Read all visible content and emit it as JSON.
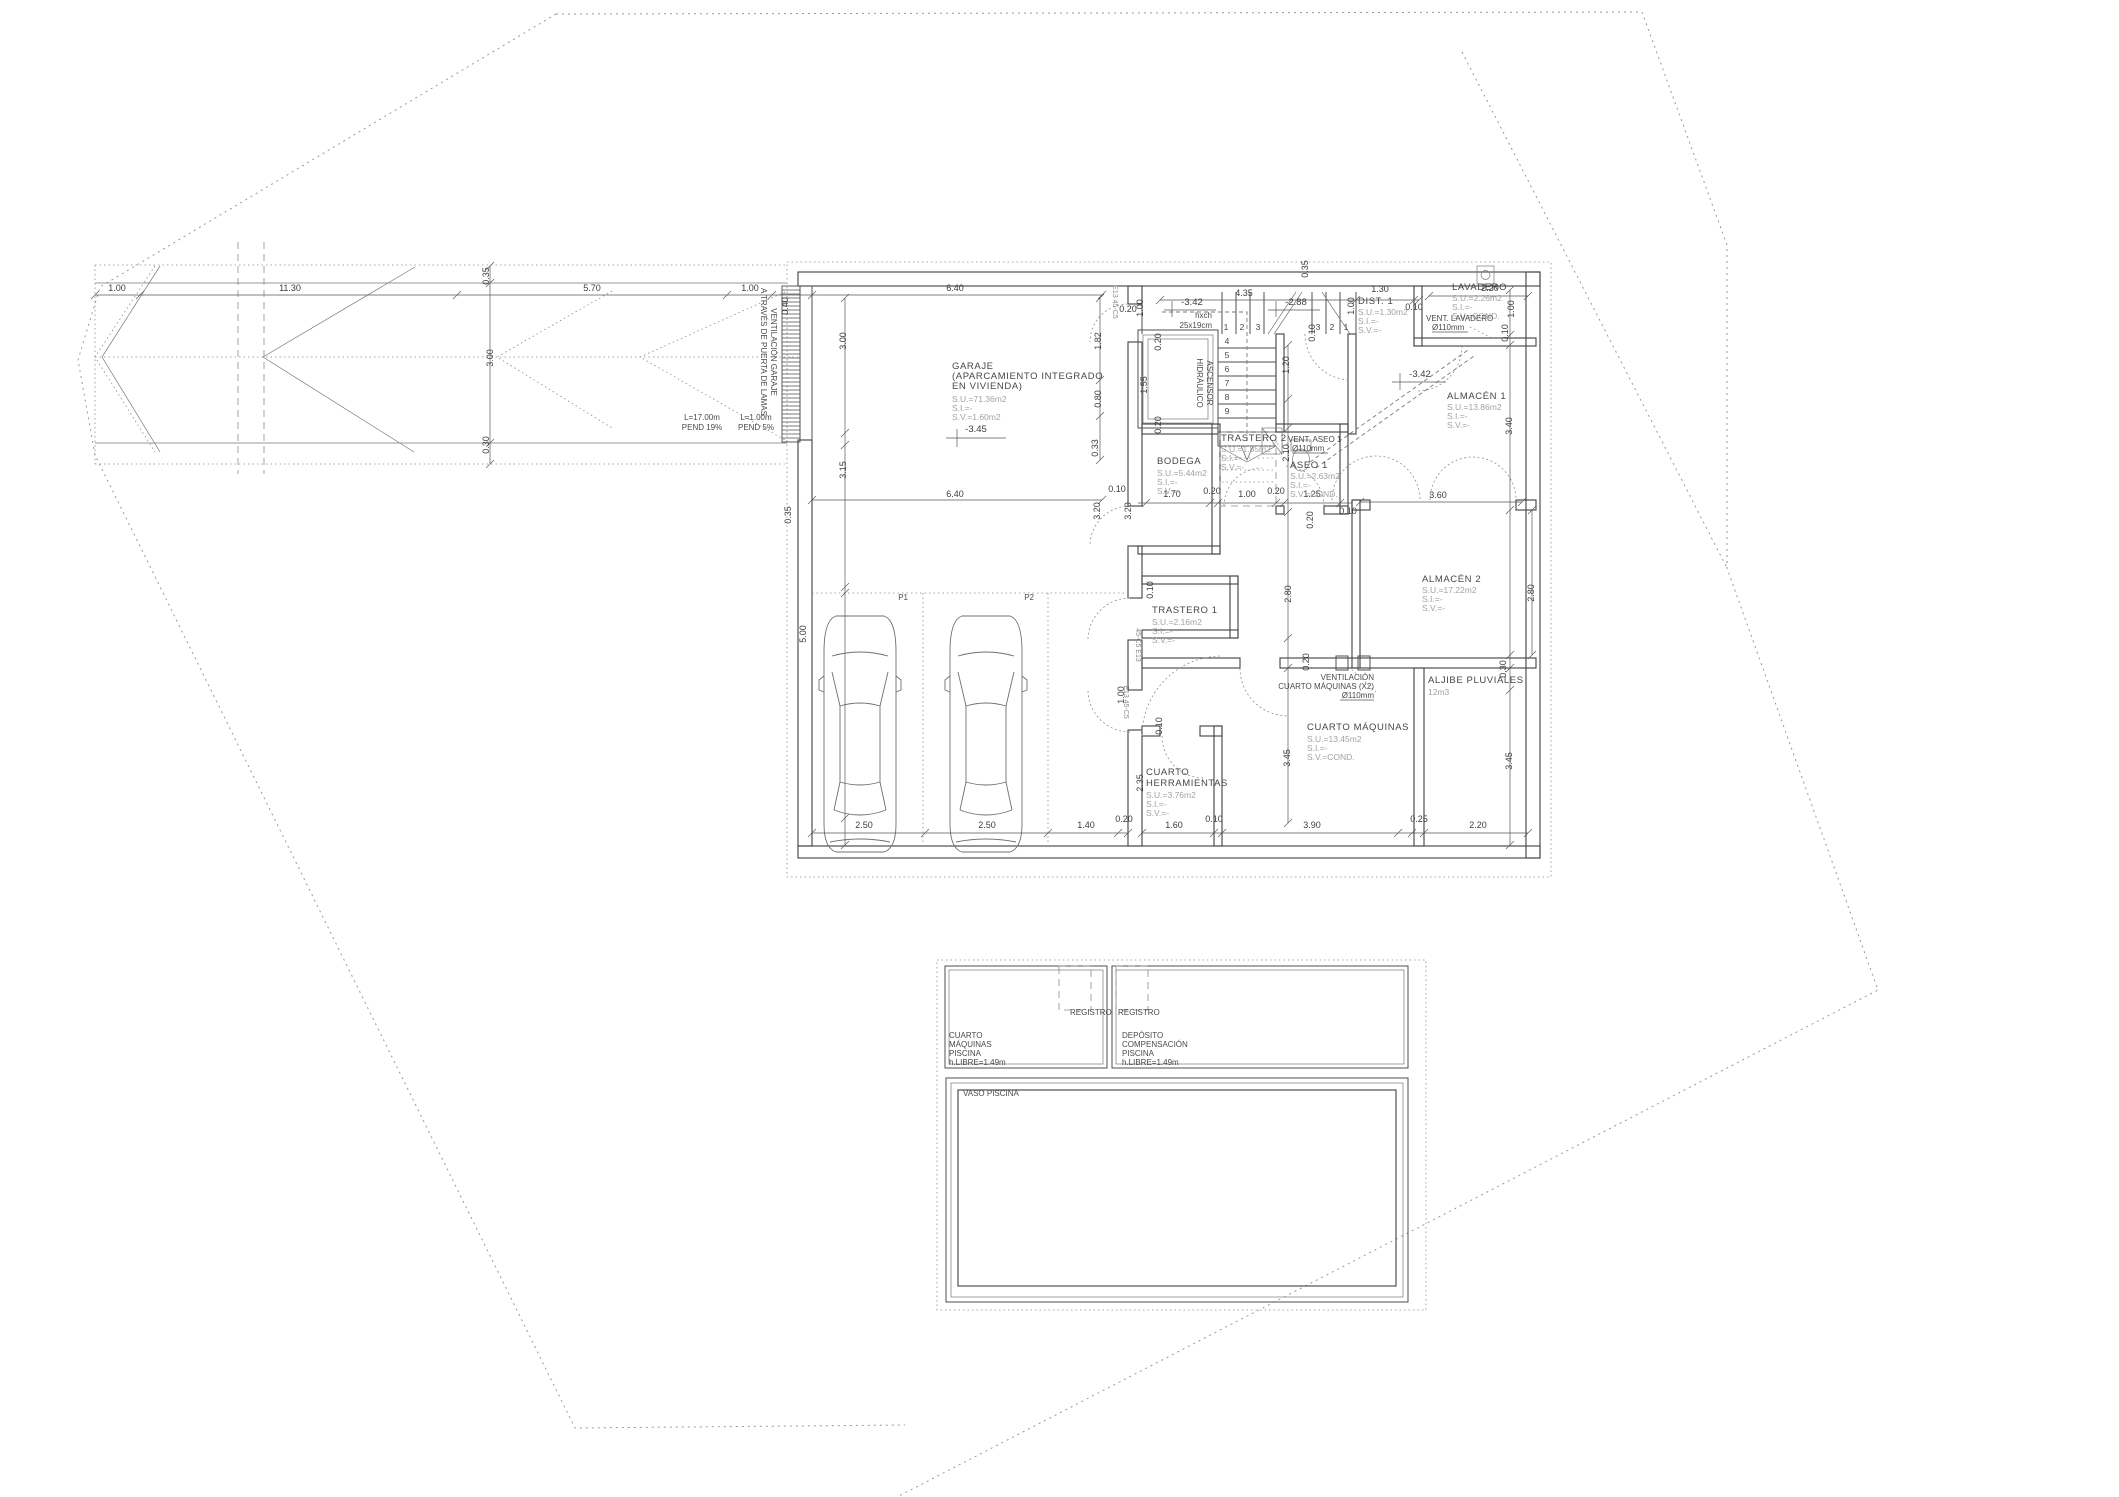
{
  "drawing": {
    "kind": "basement floor plan",
    "line_color": "#4f4f4f",
    "muted_text_color": "#a2a2a2",
    "background": "#ffffff"
  },
  "texts": [
    {
      "t": "1.00",
      "x": 117,
      "y": 291,
      "c": "dim"
    },
    {
      "t": "11.30",
      "x": 290,
      "y": 291,
      "c": "dim"
    },
    {
      "t": "5.70",
      "x": 592,
      "y": 291,
      "c": "dim"
    },
    {
      "t": "1.00",
      "x": 750,
      "y": 291,
      "c": "dim"
    },
    {
      "t": "6.40",
      "x": 955,
      "y": 291,
      "c": "dim"
    },
    {
      "t": "4.35",
      "x": 1244,
      "y": 296,
      "c": "dim"
    },
    {
      "t": "1.30",
      "x": 1380,
      "y": 292,
      "c": "dim"
    },
    {
      "t": "0.10",
      "x": 1414,
      "y": 310,
      "c": "dim"
    },
    {
      "t": "2.20",
      "x": 1490,
      "y": 291,
      "c": "dim"
    },
    {
      "t": "6.40",
      "x": 955,
      "y": 497,
      "c": "dim"
    },
    {
      "t": "0.10",
      "x": 1117,
      "y": 492,
      "c": "dim"
    },
    {
      "t": "1.70",
      "x": 1172,
      "y": 497,
      "c": "dim"
    },
    {
      "t": "0.20",
      "x": 1212,
      "y": 494,
      "c": "dim"
    },
    {
      "t": "1.00",
      "x": 1247,
      "y": 497,
      "c": "dim"
    },
    {
      "t": "0.20",
      "x": 1276,
      "y": 494,
      "c": "dim"
    },
    {
      "t": "1.25",
      "x": 1312,
      "y": 497,
      "c": "dim"
    },
    {
      "t": "0.10",
      "x": 1348,
      "y": 514,
      "c": "dim"
    },
    {
      "t": "3.60",
      "x": 1438,
      "y": 498,
      "c": "dim"
    },
    {
      "t": "0.20",
      "x": 1128,
      "y": 312,
      "c": "dim"
    },
    {
      "t": "2.50",
      "x": 864,
      "y": 828,
      "c": "dim"
    },
    {
      "t": "2.50",
      "x": 987,
      "y": 828,
      "c": "dim"
    },
    {
      "t": "1.40",
      "x": 1086,
      "y": 828,
      "c": "dim"
    },
    {
      "t": "0.20",
      "x": 1124,
      "y": 822,
      "c": "dim"
    },
    {
      "t": "1.60",
      "x": 1174,
      "y": 828,
      "c": "dim"
    },
    {
      "t": "0.10",
      "x": 1214,
      "y": 822,
      "c": "dim"
    },
    {
      "t": "3.90",
      "x": 1312,
      "y": 828,
      "c": "dim"
    },
    {
      "t": "0.25",
      "x": 1419,
      "y": 822,
      "c": "dim"
    },
    {
      "t": "2.20",
      "x": 1478,
      "y": 828,
      "c": "dim"
    },
    {
      "t": "0.35",
      "x": 489,
      "y": 276,
      "r": -90,
      "c": "dim"
    },
    {
      "t": "3.00",
      "x": 493,
      "y": 358,
      "r": -90,
      "c": "dim"
    },
    {
      "t": "0.30",
      "x": 489,
      "y": 445,
      "r": -90,
      "c": "dim"
    },
    {
      "t": "0.40",
      "x": 788,
      "y": 306,
      "r": -90,
      "c": "dim"
    },
    {
      "t": "3.00",
      "x": 846,
      "y": 341,
      "r": -90,
      "c": "dim"
    },
    {
      "t": "3.15",
      "x": 846,
      "y": 470,
      "r": -90,
      "c": "dim"
    },
    {
      "t": "0.35",
      "x": 791,
      "y": 515,
      "r": -90,
      "c": "dim"
    },
    {
      "t": "5.00",
      "x": 806,
      "y": 634,
      "r": -90,
      "c": "dim"
    },
    {
      "t": "1.82",
      "x": 1101,
      "y": 341,
      "r": -90,
      "c": "dim"
    },
    {
      "t": "0.80",
      "x": 1101,
      "y": 399,
      "r": -90,
      "c": "dim"
    },
    {
      "t": "0.33",
      "x": 1098,
      "y": 448,
      "r": -90,
      "c": "dim"
    },
    {
      "t": "1.55",
      "x": 1147,
      "y": 385,
      "r": -90,
      "c": "dim"
    },
    {
      "t": "0.20",
      "x": 1161,
      "y": 342,
      "r": -90,
      "c": "dim"
    },
    {
      "t": "0.20",
      "x": 1161,
      "y": 425,
      "r": -90,
      "c": "dim"
    },
    {
      "t": "1.00",
      "x": 1143,
      "y": 308,
      "r": -90,
      "c": "dim"
    },
    {
      "t": "0.35",
      "x": 1308,
      "y": 269,
      "r": -90,
      "c": "dim"
    },
    {
      "t": "1.00",
      "x": 1354,
      "y": 306,
      "r": -90,
      "c": "dim"
    },
    {
      "t": "1.20",
      "x": 1289,
      "y": 365,
      "r": -90,
      "c": "dim"
    },
    {
      "t": "0.10",
      "x": 1315,
      "y": 333,
      "r": -90,
      "c": "dim"
    },
    {
      "t": "2.10",
      "x": 1289,
      "y": 453,
      "r": -90,
      "c": "dim"
    },
    {
      "t": "0.20",
      "x": 1313,
      "y": 520,
      "r": -90,
      "c": "dim"
    },
    {
      "t": "3.20",
      "x": 1100,
      "y": 511,
      "r": -90,
      "c": "dim"
    },
    {
      "t": "3.20",
      "x": 1131,
      "y": 511,
      "r": -90,
      "c": "dim"
    },
    {
      "t": "1.00",
      "x": 1514,
      "y": 309,
      "r": -90,
      "c": "dim"
    },
    {
      "t": "0.10",
      "x": 1508,
      "y": 333,
      "r": -90,
      "c": "dim"
    },
    {
      "t": "3.40",
      "x": 1512,
      "y": 426,
      "r": -90,
      "c": "dim"
    },
    {
      "t": "2.80",
      "x": 1291,
      "y": 594,
      "r": -90,
      "c": "dim"
    },
    {
      "t": "2.80",
      "x": 1534,
      "y": 593,
      "r": -90,
      "c": "dim"
    },
    {
      "t": "0.20",
      "x": 1309,
      "y": 662,
      "r": -90,
      "c": "dim"
    },
    {
      "t": "0.30",
      "x": 1506,
      "y": 669,
      "r": -90,
      "c": "dim"
    },
    {
      "t": "3.45",
      "x": 1290,
      "y": 758,
      "r": -90,
      "c": "dim"
    },
    {
      "t": "3.45",
      "x": 1512,
      "y": 761,
      "r": -90,
      "c": "dim"
    },
    {
      "t": "2.35",
      "x": 1143,
      "y": 783,
      "r": -90,
      "c": "dim"
    },
    {
      "t": "1.00",
      "x": 1124,
      "y": 695,
      "r": -90,
      "c": "dim"
    },
    {
      "t": "0.10",
      "x": 1162,
      "y": 726,
      "r": -90,
      "c": "dim"
    },
    {
      "t": "0.10",
      "x": 1153,
      "y": 590,
      "r": -90,
      "c": "dim"
    },
    {
      "t": "-3.45",
      "x": 976,
      "y": 432,
      "c": "level",
      "n": "level-garaje"
    },
    {
      "t": "-3.42",
      "x": 1192,
      "y": 305,
      "c": "level",
      "n": "level-stair-landing"
    },
    {
      "t": "-2.88",
      "x": 1296,
      "y": 305,
      "c": "level",
      "n": "level-stair-mid"
    },
    {
      "t": "-3.42",
      "x": 1420,
      "y": 377,
      "c": "level",
      "n": "level-dist"
    },
    {
      "t": "GARAJE",
      "x": 952,
      "y": 369,
      "c": "room",
      "n": "room-label-garaje"
    },
    {
      "t": "(APARCAMIENTO INTEGRADO",
      "x": 952,
      "y": 379,
      "c": "room"
    },
    {
      "t": "EN VIVIENDA)",
      "x": 952,
      "y": 389,
      "c": "room"
    },
    {
      "t": "S.U.=71.36m2",
      "x": 952,
      "y": 402,
      "c": "sub"
    },
    {
      "t": "S.I.=-",
      "x": 952,
      "y": 411,
      "c": "sub"
    },
    {
      "t": "S.V.=1.60m2",
      "x": 952,
      "y": 420,
      "c": "sub"
    },
    {
      "t": "BODEGA",
      "x": 1157,
      "y": 464,
      "c": "room",
      "n": "room-label-bodega"
    },
    {
      "t": "S.U.=5.44m2",
      "x": 1157,
      "y": 476,
      "c": "sub"
    },
    {
      "t": "S.I.=-",
      "x": 1157,
      "y": 485,
      "c": "sub"
    },
    {
      "t": "S.V.=-",
      "x": 1157,
      "y": 494,
      "c": "sub"
    },
    {
      "t": "TRASTERO 2",
      "x": 1221,
      "y": 441,
      "c": "room",
      "n": "room-label-trastero-2"
    },
    {
      "t": "S.U.=1.85m2",
      "x": 1221,
      "y": 452,
      "c": "sub"
    },
    {
      "t": "S.I.=-",
      "x": 1221,
      "y": 461,
      "c": "sub"
    },
    {
      "t": "S.V.=-",
      "x": 1221,
      "y": 470,
      "c": "sub"
    },
    {
      "t": "ASEO 1",
      "x": 1290,
      "y": 468,
      "c": "room",
      "n": "room-label-aseo-1"
    },
    {
      "t": "S.U.=2.63m2",
      "x": 1290,
      "y": 479,
      "c": "sub"
    },
    {
      "t": "S.I.=-",
      "x": 1290,
      "y": 488,
      "c": "sub"
    },
    {
      "t": "S.V.=COND.",
      "x": 1290,
      "y": 497,
      "c": "sub"
    },
    {
      "t": "DIST. 1",
      "x": 1358,
      "y": 304,
      "c": "room",
      "n": "room-label-dist-1"
    },
    {
      "t": "S.U.=1.30m2",
      "x": 1358,
      "y": 315,
      "c": "sub"
    },
    {
      "t": "S.I.=-",
      "x": 1358,
      "y": 324,
      "c": "sub"
    },
    {
      "t": "S.V.=-",
      "x": 1358,
      "y": 333,
      "c": "sub"
    },
    {
      "t": "LAVADERO",
      "x": 1452,
      "y": 290,
      "c": "room",
      "n": "room-label-lavadero"
    },
    {
      "t": "S.U.=2.26m2",
      "x": 1452,
      "y": 301,
      "c": "sub"
    },
    {
      "t": "S.I.=-",
      "x": 1452,
      "y": 310,
      "c": "sub"
    },
    {
      "t": "S.V.=COND.",
      "x": 1452,
      "y": 319,
      "c": "sub"
    },
    {
      "t": "ALMACÉN 1",
      "x": 1447,
      "y": 399,
      "c": "room",
      "n": "room-label-almacen-1"
    },
    {
      "t": "S.U.=13.86m2",
      "x": 1447,
      "y": 410,
      "c": "sub"
    },
    {
      "t": "S.I.=-",
      "x": 1447,
      "y": 419,
      "c": "sub"
    },
    {
      "t": "S.V.=-",
      "x": 1447,
      "y": 428,
      "c": "sub"
    },
    {
      "t": "ALMACÉN 2",
      "x": 1422,
      "y": 582,
      "c": "room",
      "n": "room-label-almacen-2"
    },
    {
      "t": "S.U.=17.22m2",
      "x": 1422,
      "y": 593,
      "c": "sub"
    },
    {
      "t": "S.I.=-",
      "x": 1422,
      "y": 602,
      "c": "sub"
    },
    {
      "t": "S.V.=-",
      "x": 1422,
      "y": 611,
      "c": "sub"
    },
    {
      "t": "TRASTERO 1",
      "x": 1152,
      "y": 613,
      "c": "room",
      "n": "room-label-trastero-1"
    },
    {
      "t": "S.U.=2.16m2",
      "x": 1152,
      "y": 625,
      "c": "sub"
    },
    {
      "t": "S.I.=-",
      "x": 1152,
      "y": 634,
      "c": "sub"
    },
    {
      "t": "S.V.=-",
      "x": 1152,
      "y": 643,
      "c": "sub"
    },
    {
      "t": "CUARTO",
      "x": 1146,
      "y": 775,
      "c": "room",
      "n": "room-label-cuarto-herramientas"
    },
    {
      "t": "HERRAMIENTAS",
      "x": 1146,
      "y": 786,
      "c": "room"
    },
    {
      "t": "S.U.=3.76m2",
      "x": 1146,
      "y": 798,
      "c": "sub"
    },
    {
      "t": "S.I.=-",
      "x": 1146,
      "y": 807,
      "c": "sub"
    },
    {
      "t": "S.V.=-",
      "x": 1146,
      "y": 816,
      "c": "sub"
    },
    {
      "t": "CUARTO MÁQUINAS",
      "x": 1307,
      "y": 730,
      "c": "room",
      "n": "room-label-cuarto-maquinas"
    },
    {
      "t": "S.U.=13.45m2",
      "x": 1307,
      "y": 742,
      "c": "sub"
    },
    {
      "t": "S.I.=-",
      "x": 1307,
      "y": 751,
      "c": "sub"
    },
    {
      "t": "S.V.=COND.",
      "x": 1307,
      "y": 760,
      "c": "sub"
    },
    {
      "t": "ALJIBE PLUVIALES",
      "x": 1428,
      "y": 683,
      "c": "room",
      "n": "room-label-aljibe-pluviales"
    },
    {
      "t": "12m3",
      "x": 1428,
      "y": 695,
      "c": "sub"
    },
    {
      "t": "L=17.00m",
      "x": 702,
      "y": 420,
      "a": "m",
      "c": "note",
      "n": "note-ramp-length"
    },
    {
      "t": "PEND 19%",
      "x": 702,
      "y": 430,
      "a": "m",
      "c": "note",
      "n": "note-ramp-slope"
    },
    {
      "t": "L=1.00m",
      "x": 756,
      "y": 420,
      "a": "m",
      "c": "note",
      "n": "note-landing-length"
    },
    {
      "t": "PEND 5%",
      "x": 756,
      "y": 430,
      "a": "m",
      "c": "note",
      "n": "note-landing-slope"
    },
    {
      "t": "VENTILACIÓN GARAJE",
      "x": 771,
      "y": 352,
      "r": 90,
      "a": "m",
      "c": "note",
      "n": "note-ventilacion-garaje"
    },
    {
      "t": "A TRAVÉS DE PUERTA DE LAMAS",
      "x": 761,
      "y": 352,
      "r": 90,
      "a": "m",
      "c": "note"
    },
    {
      "t": "P1",
      "x": 908,
      "y": 600,
      "a": "e",
      "c": "note",
      "n": "parking-label-p1"
    },
    {
      "t": "P2",
      "x": 1034,
      "y": 600,
      "a": "e",
      "c": "note",
      "n": "parking-label-p2"
    },
    {
      "t": "hxch",
      "x": 1212,
      "y": 318,
      "a": "e",
      "c": "note",
      "n": "note-stair-riser"
    },
    {
      "t": "25x19cm",
      "x": 1212,
      "y": 328,
      "a": "e",
      "c": "note"
    },
    {
      "t": "1",
      "x": 1226,
      "y": 330,
      "c": "num",
      "n": "step-number"
    },
    {
      "t": "2",
      "x": 1242,
      "y": 330,
      "c": "num",
      "n": "step-number"
    },
    {
      "t": "3",
      "x": 1258,
      "y": 330,
      "c": "num",
      "n": "step-number"
    },
    {
      "t": "3",
      "x": 1318,
      "y": 330,
      "c": "num",
      "n": "step-number"
    },
    {
      "t": "2",
      "x": 1332,
      "y": 330,
      "c": "num",
      "n": "step-number"
    },
    {
      "t": "1",
      "x": 1346,
      "y": 330,
      "c": "num",
      "n": "step-number"
    },
    {
      "t": "4",
      "x": 1227,
      "y": 344,
      "c": "num",
      "n": "step-number"
    },
    {
      "t": "5",
      "x": 1227,
      "y": 358,
      "c": "num",
      "n": "step-number"
    },
    {
      "t": "6",
      "x": 1227,
      "y": 372,
      "c": "num",
      "n": "step-number"
    },
    {
      "t": "7",
      "x": 1227,
      "y": 386,
      "c": "num",
      "n": "step-number"
    },
    {
      "t": "8",
      "x": 1227,
      "y": 400,
      "c": "num",
      "n": "step-number"
    },
    {
      "t": "9",
      "x": 1227,
      "y": 414,
      "c": "num",
      "n": "step-number"
    },
    {
      "t": "ASCENSOR",
      "x": 1207,
      "y": 383,
      "r": 90,
      "a": "m",
      "c": "note",
      "n": "label-ascensor-hidraulico"
    },
    {
      "t": "HIDRÁULICO",
      "x": 1197,
      "y": 383,
      "r": 90,
      "a": "m",
      "c": "note"
    },
    {
      "t": "VENT. LAVADERO",
      "x": 1426,
      "y": 321,
      "c": "note",
      "n": "note-vent-lavadero"
    },
    {
      "t": "Ø110mm",
      "x": 1432,
      "y": 330,
      "c": "note"
    },
    {
      "t": "VENT. ASEO 1",
      "x": 1288,
      "y": 442,
      "c": "note",
      "n": "note-vent-aseo"
    },
    {
      "t": "Ø110mm",
      "x": 1292,
      "y": 451,
      "c": "note"
    },
    {
      "t": "VENTILACIÓN",
      "x": 1374,
      "y": 680,
      "a": "e",
      "c": "note",
      "n": "note-vent-cuarto-maquinas"
    },
    {
      "t": "CUARTO MÁQUINAS (X2)",
      "x": 1374,
      "y": 689,
      "a": "e",
      "c": "note"
    },
    {
      "t": "Ø110mm",
      "x": 1374,
      "y": 698,
      "a": "e",
      "c": "note"
    },
    {
      "t": "E13 45-C5",
      "x": 1113,
      "y": 302,
      "r": 90,
      "a": "m",
      "c": "tag",
      "n": "wall-tag"
    },
    {
      "t": "45-C5 E13",
      "x": 1136,
      "y": 645,
      "r": 90,
      "a": "m",
      "c": "tag",
      "n": "wall-tag"
    },
    {
      "t": "E13 45-C5",
      "x": 1124,
      "y": 702,
      "r": 90,
      "a": "m",
      "c": "tag",
      "n": "wall-tag"
    },
    {
      "t": "REGISTRO",
      "x": 1070,
      "y": 1015,
      "c": "note",
      "n": "label-registro-1"
    },
    {
      "t": "REGISTRO",
      "x": 1118,
      "y": 1015,
      "c": "note",
      "n": "label-registro-2"
    },
    {
      "t": "CUARTO",
      "x": 949,
      "y": 1038,
      "c": "note",
      "n": "room-label-cuarto-maquinas-piscina"
    },
    {
      "t": "MÁQUINAS",
      "x": 949,
      "y": 1047,
      "c": "note"
    },
    {
      "t": "PISCINA",
      "x": 949,
      "y": 1056,
      "c": "note"
    },
    {
      "t": "h.LIBRE=1.49m",
      "x": 949,
      "y": 1065,
      "c": "note"
    },
    {
      "t": "DEPÓSITO",
      "x": 1122,
      "y": 1038,
      "c": "note",
      "n": "room-label-deposito-compensacion"
    },
    {
      "t": "COMPENSACIÓN",
      "x": 1122,
      "y": 1047,
      "c": "note"
    },
    {
      "t": "PISCINA",
      "x": 1122,
      "y": 1056,
      "c": "note"
    },
    {
      "t": "h.LIBRE=1.49m",
      "x": 1122,
      "y": 1065,
      "c": "note"
    },
    {
      "t": "VASO PISCINA",
      "x": 963,
      "y": 1096,
      "c": "note",
      "n": "room-label-vaso-piscina"
    }
  ]
}
